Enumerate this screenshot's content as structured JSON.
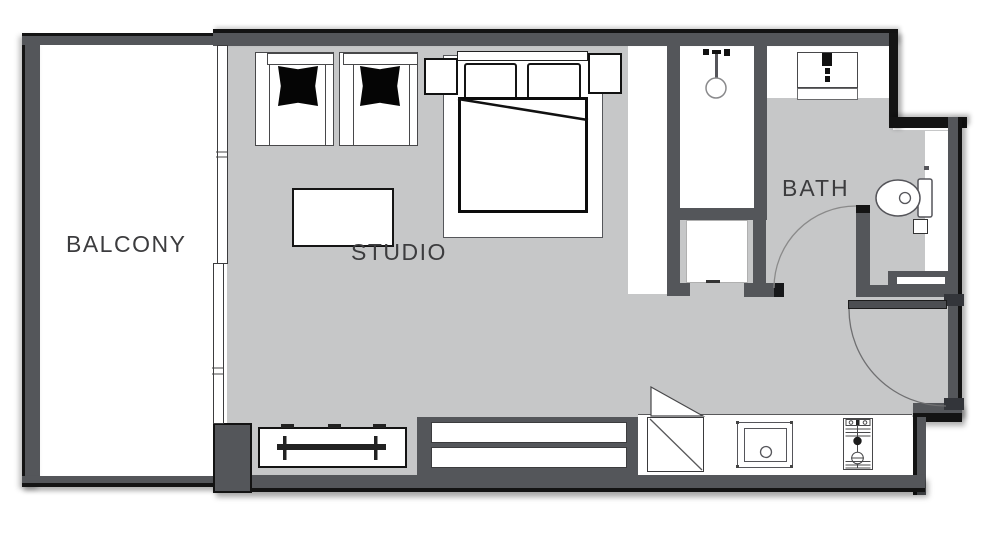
{
  "floor_plan": {
    "title": "Studio apartment floor plan",
    "labels": {
      "balcony": "BALCONY",
      "studio": "STUDIO",
      "bath": "BATH"
    },
    "colors": {
      "wall": "#54565a",
      "wall_edge": "#141414",
      "floor": "#c6c7c8",
      "surface": "#ffffff",
      "furniture_line": "#2b2b2b",
      "cushion": "#050505"
    },
    "furniture": [
      "armchair-left",
      "armchair-right",
      "coffee-table",
      "double-bed",
      "bed-pillow-left",
      "bed-pillow-right",
      "nightstand-left",
      "nightstand-right",
      "tv-console",
      "wardrobe",
      "refrigerator",
      "kitchen-sink",
      "cooktop",
      "shower",
      "linen-closet",
      "vanity-sink",
      "toilet",
      "toilet-paper-holder",
      "balcony-sliding-door",
      "bathroom-door",
      "entry-door"
    ]
  }
}
